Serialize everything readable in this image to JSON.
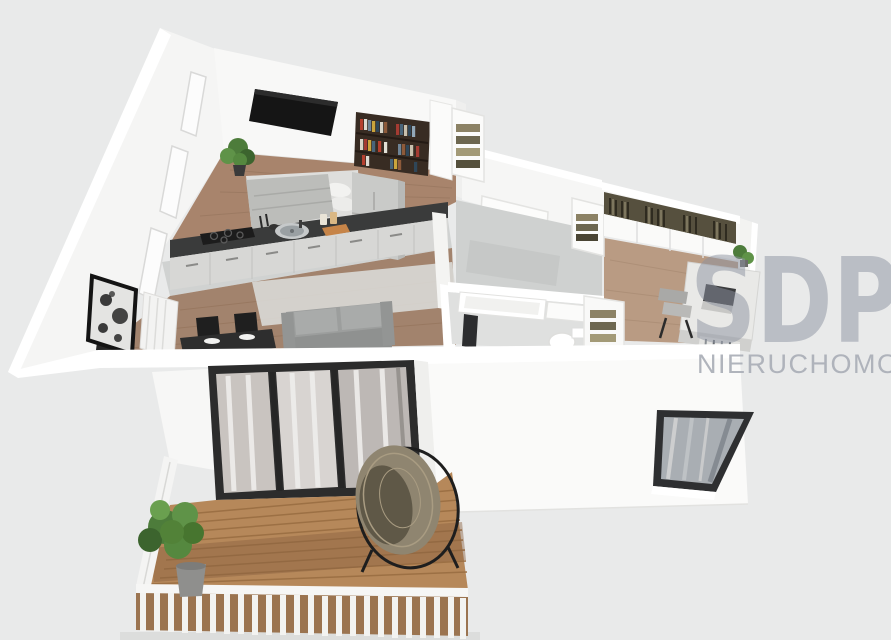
{
  "watermark": {
    "brand": "SDP",
    "tagline": "NIERUCHOMOŚCI",
    "brand_color": "#8b92a0",
    "tagline_color": "#acb0b8"
  },
  "palette": {
    "background": "#e9eaea",
    "walls": "#f7f7f6",
    "wood_floor": "#a8846c",
    "tile_floor": "#d0d2d1",
    "countertop": "#3a3b3b",
    "cabinets": "#d7d7d5",
    "sofa": "#9c9e9d",
    "deck_wood": "#b6885a",
    "plant_green": "#4d7c3b",
    "door_frame": "#2c2c2c"
  },
  "scene": {
    "type": "3d-apartment-floor-plan-render",
    "rooms": [
      {
        "name": "bedroom-kitchen",
        "items": [
          "wall-tv",
          "bookshelf",
          "potted-plant",
          "double-bed",
          "open-shelf-wardrobe",
          "kitchen-counter",
          "cooktop",
          "sink",
          "cutting-board",
          "tall-cabinet"
        ]
      },
      {
        "name": "living-area",
        "items": [
          "sofa",
          "rug",
          "dining-table",
          "dining-chairs",
          "wall-art",
          "radiator"
        ]
      },
      {
        "name": "hallway",
        "items": [
          "entry-door",
          "open-wardrobe",
          "tile-floor"
        ]
      },
      {
        "name": "bathroom",
        "items": [
          "bathtub",
          "towel",
          "toilet",
          "linen-closet"
        ]
      },
      {
        "name": "office-bedroom",
        "items": [
          "hanging-clothes-wardrobe",
          "desk",
          "laptop",
          "desk-chair",
          "desk-plant"
        ]
      },
      {
        "name": "balcony",
        "items": [
          "wooden-deck",
          "railing",
          "sliding-glass-doors",
          "potted-plant",
          "hanging-egg-chair"
        ]
      },
      {
        "name": "facade",
        "items": [
          "window"
        ]
      }
    ]
  }
}
